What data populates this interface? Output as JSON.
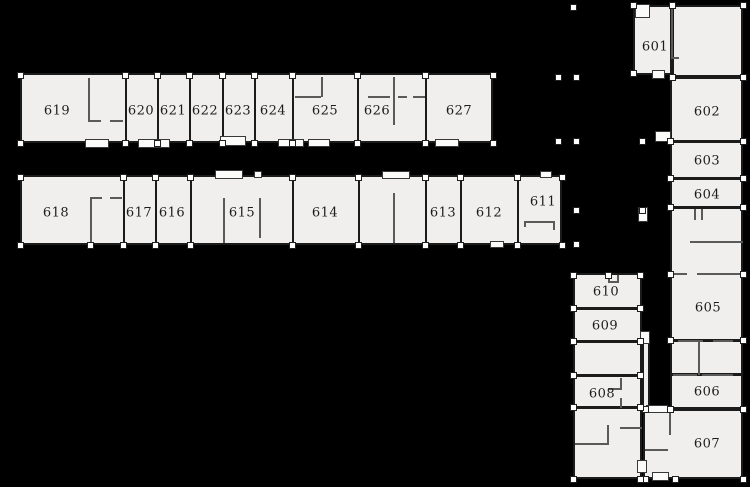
{
  "canvas": {
    "width": 750,
    "height": 487
  },
  "colors": {
    "background": "#000000",
    "floor_fill": "#f0efed",
    "wall": "#1b1b1b",
    "partition_wall": "#5a5a5a",
    "column_fill": "#ffffff",
    "label_text": "#1c1c1c"
  },
  "plan_title": "Sixth-floor plan, rooms 601-627",
  "rooms": [
    {
      "number": "619",
      "x": 20,
      "y": 75,
      "w": 105,
      "h": 68,
      "label_x": 57,
      "label_y": 111
    },
    {
      "number": "620",
      "x": 125,
      "y": 75,
      "w": 32,
      "h": 68,
      "label_x": 141,
      "label_y": 111
    },
    {
      "number": "621",
      "x": 157,
      "y": 75,
      "w": 32,
      "h": 68,
      "label_x": 173,
      "label_y": 111
    },
    {
      "number": "622",
      "x": 189,
      "y": 75,
      "w": 33,
      "h": 68,
      "label_x": 205,
      "label_y": 111
    },
    {
      "number": "623",
      "x": 222,
      "y": 75,
      "w": 32,
      "h": 68,
      "label_x": 238,
      "label_y": 111
    },
    {
      "number": "624",
      "x": 254,
      "y": 75,
      "w": 38,
      "h": 68,
      "label_x": 273,
      "label_y": 111
    },
    {
      "number": "625",
      "x": 292,
      "y": 75,
      "w": 65,
      "h": 68,
      "label_x": 325,
      "label_y": 111
    },
    {
      "number": "626",
      "x": 357,
      "y": 75,
      "w": 68,
      "h": 68,
      "label_x": 377,
      "label_y": 111
    },
    {
      "number": "627",
      "x": 425,
      "y": 75,
      "w": 68,
      "h": 68,
      "label_x": 459,
      "label_y": 111
    },
    {
      "number": "618",
      "x": 20,
      "y": 177,
      "w": 103,
      "h": 68,
      "label_x": 56,
      "label_y": 213
    },
    {
      "number": "617",
      "x": 123,
      "y": 177,
      "w": 32,
      "h": 68,
      "label_x": 139,
      "label_y": 213
    },
    {
      "number": "616",
      "x": 155,
      "y": 177,
      "w": 35,
      "h": 68,
      "label_x": 172,
      "label_y": 213
    },
    {
      "number": "615",
      "x": 190,
      "y": 177,
      "w": 102,
      "h": 68,
      "label_x": 242,
      "label_y": 213
    },
    {
      "number": "614",
      "x": 292,
      "y": 177,
      "w": 66,
      "h": 68,
      "label_x": 325,
      "label_y": 213
    },
    {
      "number": "613",
      "x": 425,
      "y": 177,
      "w": 35,
      "h": 68,
      "label_x": 443,
      "label_y": 213
    },
    {
      "number": "612",
      "x": 460,
      "y": 177,
      "w": 57,
      "h": 68,
      "label_x": 489,
      "label_y": 213
    },
    {
      "number": "611",
      "x": 517,
      "y": 177,
      "w": 45,
      "h": 68,
      "label_x": 543,
      "label_y": 202
    },
    {
      "number": "601",
      "x": 633,
      "y": 5,
      "w": 39,
      "h": 70,
      "label_x": 655,
      "label_y": 47
    },
    {
      "number": "602",
      "x": 670,
      "y": 77,
      "w": 73,
      "h": 64,
      "label_x": 707,
      "label_y": 112
    },
    {
      "number": "603",
      "x": 670,
      "y": 141,
      "w": 73,
      "h": 37,
      "label_x": 707,
      "label_y": 161
    },
    {
      "number": "604",
      "x": 670,
      "y": 178,
      "w": 73,
      "h": 29,
      "label_x": 707,
      "label_y": 195
    },
    {
      "number": "605",
      "x": 670,
      "y": 207,
      "w": 73,
      "h": 133,
      "label_x": 708,
      "label_y": 308
    },
    {
      "number": "606",
      "x": 670,
      "y": 374,
      "w": 73,
      "h": 35,
      "label_x": 707,
      "label_y": 392
    },
    {
      "number": "607",
      "x": 643,
      "y": 409,
      "w": 100,
      "h": 70,
      "label_x": 707,
      "label_y": 444
    },
    {
      "number": "610",
      "x": 573,
      "y": 273,
      "w": 69,
      "h": 35,
      "label_x": 606,
      "label_y": 292
    },
    {
      "number": "609",
      "x": 573,
      "y": 308,
      "w": 69,
      "h": 33,
      "label_x": 605,
      "label_y": 326
    },
    {
      "number": "608",
      "x": 573,
      "y": 375,
      "w": 69,
      "h": 32,
      "label_x": 602,
      "label_y": 394
    }
  ],
  "floor_blocks": [
    [
      20,
      73,
      473,
      70
    ],
    [
      20,
      175,
      542,
      70
    ],
    [
      633,
      5,
      39,
      70
    ],
    [
      672,
      5,
      71,
      72
    ],
    [
      670,
      77,
      73,
      332
    ],
    [
      643,
      409,
      100,
      70
    ],
    [
      573,
      273,
      69,
      206
    ],
    [
      642,
      333,
      8,
      76
    ]
  ],
  "walls": [
    [
      125,
      75,
      2,
      68
    ],
    [
      157,
      75,
      2,
      68
    ],
    [
      189,
      75,
      2,
      68
    ],
    [
      222,
      75,
      2,
      68
    ],
    [
      254,
      75,
      2,
      68
    ],
    [
      292,
      75,
      2,
      68
    ],
    [
      357,
      75,
      2,
      68
    ],
    [
      425,
      75,
      2,
      68
    ],
    [
      123,
      177,
      2,
      68
    ],
    [
      155,
      177,
      2,
      68
    ],
    [
      190,
      177,
      2,
      68
    ],
    [
      292,
      177,
      2,
      68
    ],
    [
      358,
      177,
      2,
      68
    ],
    [
      425,
      177,
      2,
      68
    ],
    [
      460,
      177,
      2,
      68
    ],
    [
      517,
      177,
      2,
      68
    ],
    [
      672,
      140,
      69,
      3
    ],
    [
      672,
      177,
      69,
      3
    ],
    [
      672,
      206,
      69,
      3
    ],
    [
      672,
      339,
      69,
      3
    ],
    [
      672,
      373,
      69,
      3
    ],
    [
      575,
      307,
      65,
      3
    ],
    [
      575,
      340,
      65,
      3
    ],
    [
      575,
      374,
      65,
      3
    ],
    [
      575,
      406,
      65,
      3
    ]
  ],
  "partitions": [
    [
      88,
      78,
      2,
      43
    ],
    [
      88,
      120,
      13,
      2
    ],
    [
      110,
      120,
      13,
      2
    ],
    [
      90,
      198,
      2,
      45
    ],
    [
      90,
      197,
      12,
      2
    ],
    [
      110,
      197,
      12,
      2
    ],
    [
      223,
      198,
      2,
      45
    ],
    [
      259,
      198,
      2,
      40
    ],
    [
      321,
      77,
      2,
      20
    ],
    [
      295,
      96,
      26,
      2
    ],
    [
      393,
      77,
      2,
      48
    ],
    [
      368,
      96,
      22,
      2
    ],
    [
      398,
      96,
      9,
      2
    ],
    [
      413,
      96,
      12,
      2
    ],
    [
      393,
      193,
      2,
      50
    ],
    [
      524,
      221,
      31,
      2
    ],
    [
      553,
      221,
      2,
      9
    ],
    [
      524,
      221,
      2,
      6
    ],
    [
      671,
      7,
      2,
      52
    ],
    [
      671,
      57,
      8,
      2
    ],
    [
      690,
      241,
      53,
      2
    ],
    [
      673,
      273,
      14,
      2
    ],
    [
      697,
      273,
      46,
      2
    ],
    [
      694,
      209,
      2,
      11
    ],
    [
      701,
      209,
      2,
      11
    ],
    [
      678,
      340,
      25,
      2
    ],
    [
      713,
      340,
      20,
      2
    ],
    [
      673,
      374,
      24,
      2
    ],
    [
      702,
      374,
      31,
      2
    ],
    [
      698,
      341,
      2,
      34
    ],
    [
      669,
      411,
      2,
      24
    ],
    [
      645,
      449,
      23,
      2
    ],
    [
      620,
      378,
      2,
      12
    ],
    [
      608,
      388,
      14,
      2
    ],
    [
      620,
      398,
      2,
      10
    ],
    [
      575,
      443,
      34,
      2
    ],
    [
      607,
      425,
      2,
      20
    ],
    [
      620,
      427,
      22,
      2
    ],
    [
      608,
      275,
      2,
      7
    ],
    [
      617,
      275,
      2,
      7
    ],
    [
      608,
      281,
      11,
      2
    ]
  ],
  "doors": [
    [
      85,
      139,
      24,
      9
    ],
    [
      138,
      139,
      32,
      9
    ],
    [
      220,
      136,
      26,
      10
    ],
    [
      278,
      139,
      26,
      8
    ],
    [
      308,
      139,
      22,
      8
    ],
    [
      435,
      139,
      24,
      8
    ],
    [
      215,
      170,
      28,
      9
    ],
    [
      254,
      171,
      8,
      7
    ],
    [
      382,
      171,
      28,
      8
    ],
    [
      540,
      171,
      12,
      7
    ],
    [
      490,
      241,
      14,
      7
    ],
    [
      635,
      4,
      15,
      14
    ],
    [
      652,
      70,
      13,
      9
    ],
    [
      655,
      131,
      16,
      11
    ],
    [
      638,
      207,
      10,
      15
    ],
    [
      640,
      331,
      10,
      13
    ],
    [
      637,
      460,
      10,
      13
    ],
    [
      646,
      405,
      22,
      8
    ],
    [
      652,
      472,
      17,
      9
    ]
  ],
  "columns": [
    [
      20,
      75
    ],
    [
      125,
      75
    ],
    [
      157,
      75
    ],
    [
      189,
      75
    ],
    [
      222,
      75
    ],
    [
      254,
      75
    ],
    [
      292,
      75
    ],
    [
      357,
      75
    ],
    [
      425,
      75
    ],
    [
      493,
      75
    ],
    [
      20,
      143
    ],
    [
      125,
      143
    ],
    [
      157,
      143
    ],
    [
      189,
      143
    ],
    [
      222,
      143
    ],
    [
      254,
      143
    ],
    [
      292,
      143
    ],
    [
      357,
      143
    ],
    [
      425,
      143
    ],
    [
      493,
      143
    ],
    [
      20,
      177
    ],
    [
      123,
      177
    ],
    [
      155,
      177
    ],
    [
      190,
      177
    ],
    [
      292,
      177
    ],
    [
      358,
      177
    ],
    [
      425,
      177
    ],
    [
      460,
      177
    ],
    [
      517,
      177
    ],
    [
      562,
      177
    ],
    [
      20,
      245
    ],
    [
      90,
      245
    ],
    [
      123,
      245
    ],
    [
      155,
      245
    ],
    [
      190,
      245
    ],
    [
      292,
      245
    ],
    [
      358,
      245
    ],
    [
      425,
      245
    ],
    [
      460,
      245
    ],
    [
      517,
      245
    ],
    [
      562,
      245
    ],
    [
      633,
      5
    ],
    [
      672,
      5
    ],
    [
      743,
      5
    ],
    [
      633,
      73
    ],
    [
      672,
      77
    ],
    [
      743,
      77
    ],
    [
      670,
      141
    ],
    [
      743,
      141
    ],
    [
      670,
      178
    ],
    [
      743,
      178
    ],
    [
      670,
      207
    ],
    [
      743,
      207
    ],
    [
      670,
      274
    ],
    [
      743,
      274
    ],
    [
      670,
      340
    ],
    [
      743,
      340
    ],
    [
      670,
      409
    ],
    [
      743,
      409
    ],
    [
      645,
      409
    ],
    [
      645,
      479
    ],
    [
      675,
      479
    ],
    [
      743,
      479
    ],
    [
      573,
      275
    ],
    [
      608,
      275
    ],
    [
      640,
      275
    ],
    [
      573,
      308
    ],
    [
      640,
      308
    ],
    [
      573,
      341
    ],
    [
      640,
      341
    ],
    [
      573,
      375
    ],
    [
      640,
      375
    ],
    [
      573,
      407
    ],
    [
      640,
      407
    ],
    [
      573,
      479
    ],
    [
      640,
      479
    ],
    [
      573,
      7
    ],
    [
      558,
      77
    ],
    [
      576,
      77
    ],
    [
      558,
      141
    ],
    [
      576,
      141
    ],
    [
      642,
      141
    ],
    [
      576,
      210
    ],
    [
      642,
      210
    ],
    [
      576,
      244
    ]
  ]
}
